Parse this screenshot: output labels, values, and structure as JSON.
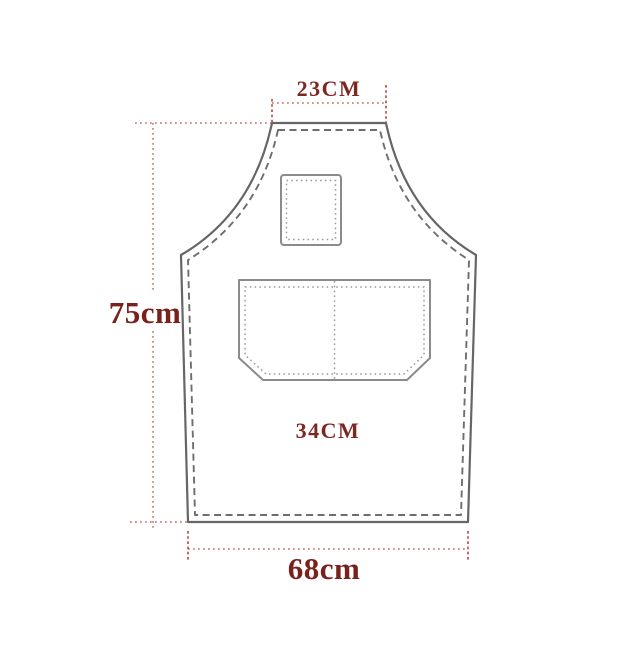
{
  "diagram": {
    "labels": {
      "neck_width": "23CM",
      "body_height": "75cm",
      "pocket_width": "34CM",
      "hem_width": "68cm"
    },
    "colors": {
      "dimension_line": "#c4736d",
      "dimension_tick": "#b8453d",
      "label_small_text": "#7d2721",
      "label_large_text": "#7a211c",
      "apron_outline": "#666666",
      "seam_stitch": "#6e6e6e",
      "pocket_outline": "#8b8b8b",
      "pocket_stitch": "#9b9b9b",
      "background": "#ffffff"
    }
  }
}
